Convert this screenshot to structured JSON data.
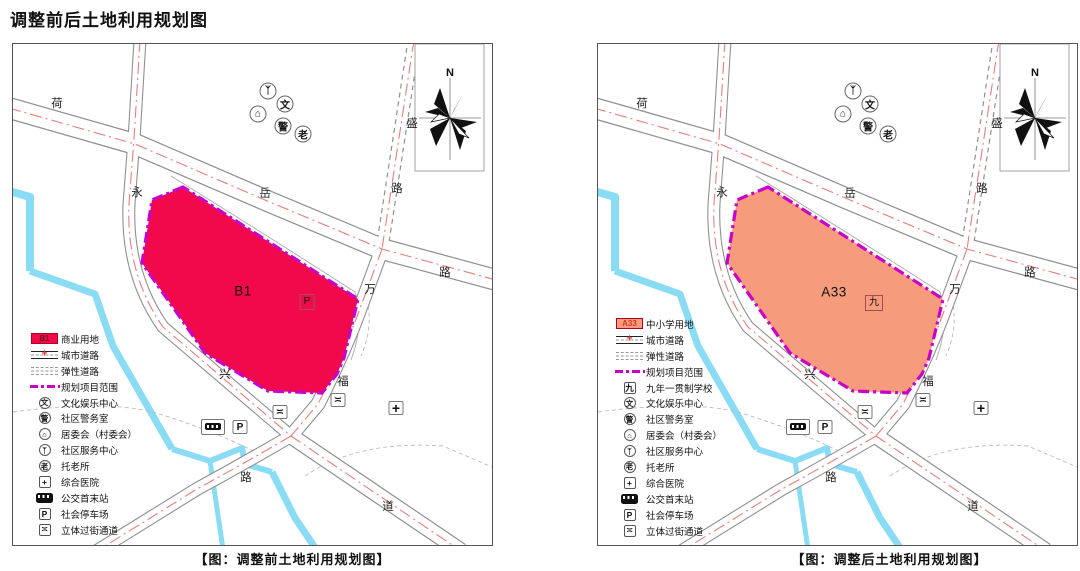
{
  "title": "调整前后土地利用规划图",
  "north_label": "N",
  "colors": {
    "commercial_red": "#F2094C",
    "school_orange": "#F69B7C",
    "boundary_magenta": "#C800C8",
    "water_blue": "#8ADCF4",
    "centerline_red": "#E4807A",
    "road_gray": "#909090"
  },
  "road_labels": [
    {
      "t": "荷",
      "x": 44,
      "y": 59
    },
    {
      "t": "永",
      "x": 124,
      "y": 148
    },
    {
      "t": "岳",
      "x": 252,
      "y": 149
    },
    {
      "t": "盛",
      "x": 399,
      "y": 79
    },
    {
      "t": "路",
      "x": 384,
      "y": 144
    },
    {
      "t": "万",
      "x": 357,
      "y": 245
    },
    {
      "t": "路",
      "x": 432,
      "y": 228
    },
    {
      "t": "兴",
      "x": 212,
      "y": 330
    },
    {
      "t": "福",
      "x": 330,
      "y": 337
    },
    {
      "t": "路",
      "x": 233,
      "y": 433
    },
    {
      "t": "道",
      "x": 375,
      "y": 462
    }
  ],
  "map_icons": [
    {
      "name": "community-service-icon",
      "cls": "mc",
      "glyph": "ᛉ",
      "x": 255,
      "y": 47
    },
    {
      "name": "culture-icon",
      "cls": "mc",
      "glyph": "文",
      "x": 272,
      "y": 60
    },
    {
      "name": "committee-icon",
      "cls": "mc",
      "glyph": "⌂",
      "x": 245,
      "y": 70
    },
    {
      "name": "police-icon",
      "cls": "mc",
      "glyph": "警",
      "x": 270,
      "y": 82
    },
    {
      "name": "elderly-care-icon",
      "cls": "mc",
      "glyph": "老",
      "x": 290,
      "y": 90
    },
    {
      "name": "overpass-icon",
      "cls": "mb",
      "glyph": "≍",
      "x": 267,
      "y": 368
    },
    {
      "name": "overpass-icon",
      "cls": "mb",
      "glyph": "≍",
      "x": 325,
      "y": 356
    },
    {
      "name": "hospital-icon",
      "cls": "mb mbplus",
      "glyph": "+",
      "x": 383,
      "y": 364
    },
    {
      "name": "bus-terminal-icon",
      "cls": "mbus",
      "glyph": "",
      "x": 200,
      "y": 383
    },
    {
      "name": "parking-icon",
      "cls": "mb",
      "glyph": "P",
      "x": 227,
      "y": 383
    }
  ],
  "left": {
    "zone_label": "B1",
    "zone_tag": "P",
    "caption": "【图：调整前土地利用规划图】",
    "legend": [
      {
        "sym": "swatch",
        "glyph": "B1",
        "label": "商业用地",
        "color": "#F2094C",
        "text_color": "#6E0018",
        "icon": "commercial-land-swatch"
      },
      {
        "sym": "road",
        "glyph": "",
        "label": "城市道路",
        "icon": "city-road-symbol"
      },
      {
        "sym": "dashed",
        "glyph": "",
        "label": "弹性道路",
        "icon": "flexible-road-symbol"
      },
      {
        "sym": "boundary",
        "glyph": "",
        "label": "规划项目范围",
        "icon": "project-boundary-symbol"
      },
      {
        "sym": "circle",
        "glyph": "文",
        "label": "文化娱乐中心",
        "icon": "culture-icon"
      },
      {
        "sym": "circle",
        "glyph": "警",
        "label": "社区警务室",
        "icon": "police-icon"
      },
      {
        "sym": "circle",
        "glyph": "⌂",
        "label": "居委会（村委会）",
        "icon": "committee-icon"
      },
      {
        "sym": "circle",
        "glyph": "ᛉ",
        "label": "社区服务中心",
        "icon": "community-service-icon"
      },
      {
        "sym": "circle",
        "glyph": "老",
        "label": "托老所",
        "icon": "elderly-care-icon"
      },
      {
        "sym": "box",
        "glyph": "+",
        "label": "综合医院",
        "icon": "hospital-icon"
      },
      {
        "sym": "bus",
        "glyph": "",
        "label": "公交首末站",
        "icon": "bus-terminal-icon"
      },
      {
        "sym": "box",
        "glyph": "P",
        "label": "社会停车场",
        "icon": "parking-icon"
      },
      {
        "sym": "box",
        "glyph": "≍",
        "label": "立体过街通道",
        "icon": "overpass-icon"
      }
    ]
  },
  "right": {
    "zone_label": "A33",
    "zone_tag": "九",
    "caption": "【图：调整后土地利用规划图】",
    "legend": [
      {
        "sym": "swatch",
        "glyph": "A33",
        "label": "中小学用地",
        "color": "#F69B7C",
        "text_color": "#D23B23",
        "icon": "school-land-swatch"
      },
      {
        "sym": "road",
        "glyph": "",
        "label": "城市道路",
        "icon": "city-road-symbol"
      },
      {
        "sym": "dashed",
        "glyph": "",
        "label": "弹性道路",
        "icon": "flexible-road-symbol"
      },
      {
        "sym": "boundary",
        "glyph": "",
        "label": "规划项目范围",
        "icon": "project-boundary-symbol"
      },
      {
        "sym": "box",
        "glyph": "九",
        "label": "九年一贯制学校",
        "icon": "nine-year-school-icon"
      },
      {
        "sym": "circle",
        "glyph": "文",
        "label": "文化娱乐中心",
        "icon": "culture-icon"
      },
      {
        "sym": "circle",
        "glyph": "警",
        "label": "社区警务室",
        "icon": "police-icon"
      },
      {
        "sym": "circle",
        "glyph": "⌂",
        "label": "居委会（村委会）",
        "icon": "committee-icon"
      },
      {
        "sym": "circle",
        "glyph": "ᛉ",
        "label": "社区服务中心",
        "icon": "community-service-icon"
      },
      {
        "sym": "circle",
        "glyph": "老",
        "label": "托老所",
        "icon": "elderly-care-icon"
      },
      {
        "sym": "box",
        "glyph": "+",
        "label": "综合医院",
        "icon": "hospital-icon"
      },
      {
        "sym": "bus",
        "glyph": "",
        "label": "公交首末站",
        "icon": "bus-terminal-icon"
      },
      {
        "sym": "box",
        "glyph": "P",
        "label": "社会停车场",
        "icon": "parking-icon"
      },
      {
        "sym": "box",
        "glyph": "≍",
        "label": "立体过街通道",
        "icon": "overpass-icon"
      }
    ]
  }
}
